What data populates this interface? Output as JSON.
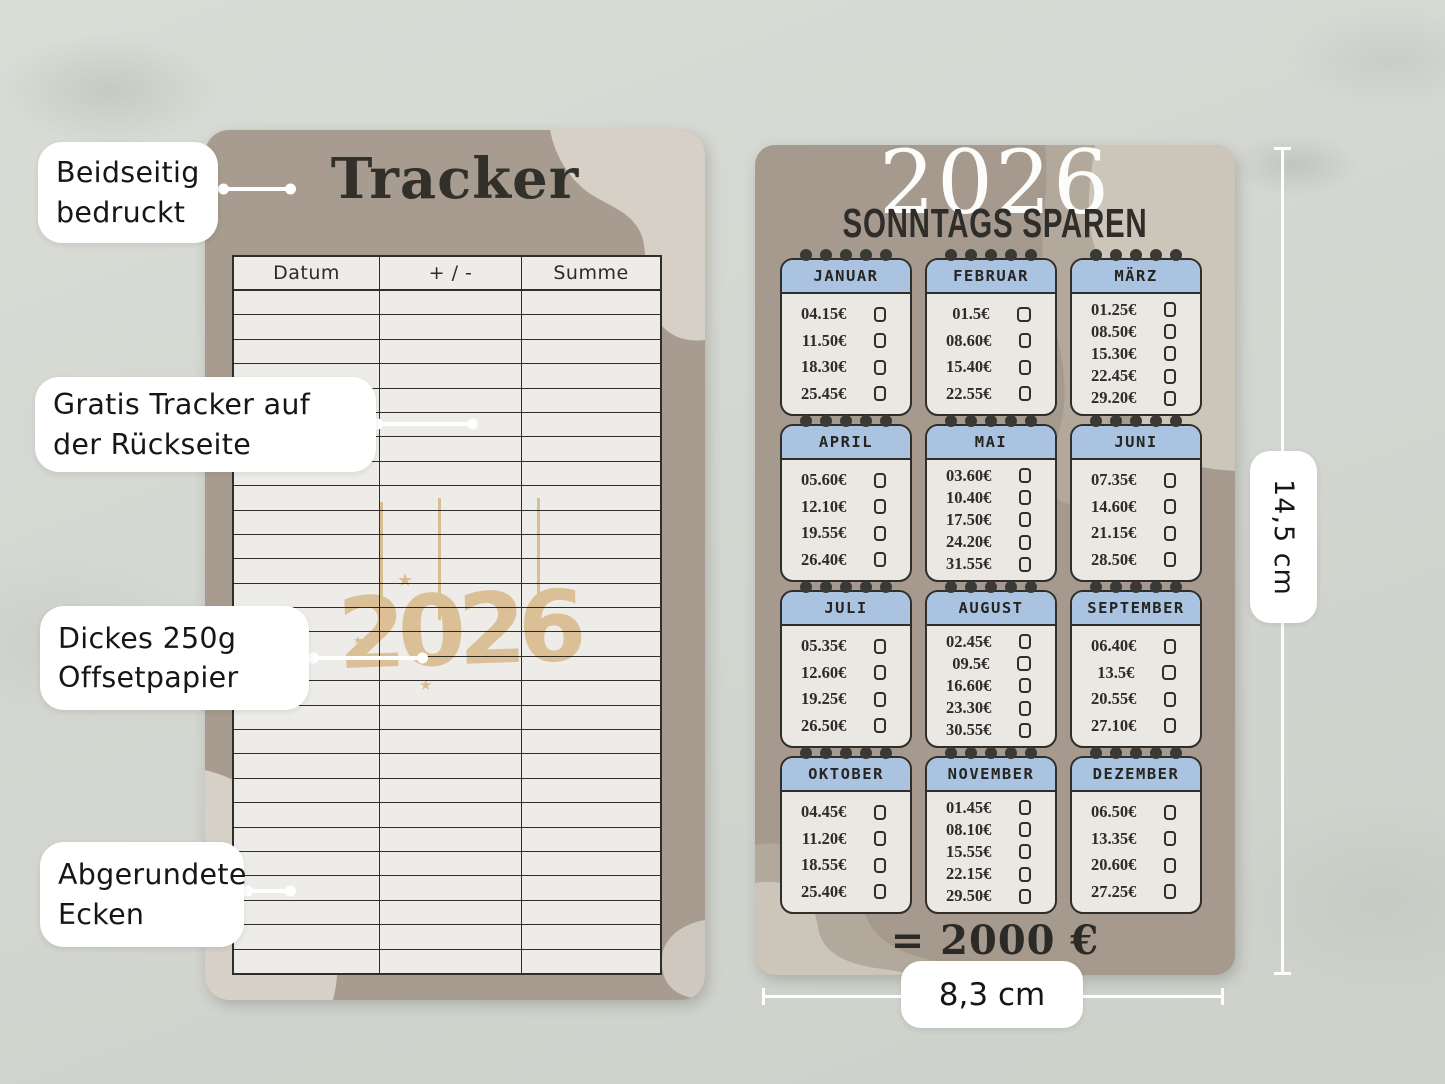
{
  "tracker_card": {
    "title": "Tracker",
    "columns": [
      "Datum",
      "+ / -",
      "Summe"
    ],
    "watermark": "2026",
    "empty_row_count": 28
  },
  "savings_card": {
    "year": "2026",
    "subtitle": "SONNTAGS SPAREN",
    "total": "= 2000 €",
    "months": [
      {
        "name": "JANUAR",
        "entries": [
          {
            "date": "04.",
            "amount": "15€"
          },
          {
            "date": "11.",
            "amount": "50€"
          },
          {
            "date": "18.",
            "amount": "30€"
          },
          {
            "date": "25.",
            "amount": "45€"
          }
        ]
      },
      {
        "name": "FEBRUAR",
        "entries": [
          {
            "date": "01.",
            "amount": "5€"
          },
          {
            "date": "08.",
            "amount": "60€"
          },
          {
            "date": "15.",
            "amount": "40€"
          },
          {
            "date": "22.",
            "amount": "55€"
          }
        ]
      },
      {
        "name": "MÄRZ",
        "entries": [
          {
            "date": "01.",
            "amount": "25€"
          },
          {
            "date": "08.",
            "amount": "50€"
          },
          {
            "date": "15.",
            "amount": "30€"
          },
          {
            "date": "22.",
            "amount": "45€"
          },
          {
            "date": "29.",
            "amount": "20€"
          }
        ]
      },
      {
        "name": "APRIL",
        "entries": [
          {
            "date": "05.",
            "amount": "60€"
          },
          {
            "date": "12.",
            "amount": "10€"
          },
          {
            "date": "19.",
            "amount": "55€"
          },
          {
            "date": "26.",
            "amount": "40€"
          }
        ]
      },
      {
        "name": "MAI",
        "entries": [
          {
            "date": "03.",
            "amount": "60€"
          },
          {
            "date": "10.",
            "amount": "40€"
          },
          {
            "date": "17.",
            "amount": "50€"
          },
          {
            "date": "24.",
            "amount": "20€"
          },
          {
            "date": "31.",
            "amount": "55€"
          }
        ]
      },
      {
        "name": "JUNI",
        "entries": [
          {
            "date": "07.",
            "amount": "35€"
          },
          {
            "date": "14.",
            "amount": "60€"
          },
          {
            "date": "21.",
            "amount": "15€"
          },
          {
            "date": "28.",
            "amount": "50€"
          }
        ]
      },
      {
        "name": "JULI",
        "entries": [
          {
            "date": "05.",
            "amount": "35€"
          },
          {
            "date": "12.",
            "amount": "60€"
          },
          {
            "date": "19.",
            "amount": "25€"
          },
          {
            "date": "26.",
            "amount": "50€"
          }
        ]
      },
      {
        "name": "AUGUST",
        "entries": [
          {
            "date": "02.",
            "amount": "45€"
          },
          {
            "date": "09.",
            "amount": "5€"
          },
          {
            "date": "16.",
            "amount": "60€"
          },
          {
            "date": "23.",
            "amount": "30€"
          },
          {
            "date": "30.",
            "amount": "55€"
          }
        ]
      },
      {
        "name": "SEPTEMBER",
        "entries": [
          {
            "date": "06.",
            "amount": "40€"
          },
          {
            "date": "13.",
            "amount": "5€"
          },
          {
            "date": "20.",
            "amount": "55€"
          },
          {
            "date": "27.",
            "amount": "10€"
          }
        ]
      },
      {
        "name": "OKTOBER",
        "entries": [
          {
            "date": "04.",
            "amount": "45€"
          },
          {
            "date": "11.",
            "amount": "20€"
          },
          {
            "date": "18.",
            "amount": "55€"
          },
          {
            "date": "25.",
            "amount": "40€"
          }
        ]
      },
      {
        "name": "NOVEMBER",
        "entries": [
          {
            "date": "01.",
            "amount": "45€"
          },
          {
            "date": "08.",
            "amount": "10€"
          },
          {
            "date": "15.",
            "amount": "55€"
          },
          {
            "date": "22.",
            "amount": "15€"
          },
          {
            "date": "29.",
            "amount": "50€"
          }
        ]
      },
      {
        "name": "DEZEMBER",
        "entries": [
          {
            "date": "06.",
            "amount": "50€"
          },
          {
            "date": "13.",
            "amount": "35€"
          },
          {
            "date": "20.",
            "amount": "60€"
          },
          {
            "date": "27.",
            "amount": "25€"
          }
        ]
      }
    ]
  },
  "annotations": {
    "labels": [
      {
        "lines": [
          "Beidseitig",
          "bedruckt"
        ]
      },
      {
        "lines": [
          "Gratis Tracker auf",
          "der Rückseite"
        ]
      },
      {
        "lines": [
          "Dickes 250g",
          "Offsetpapier"
        ]
      },
      {
        "lines": [
          "Abgerundete",
          "Ecken"
        ]
      }
    ],
    "dimensions": {
      "height_label": "14,5 cm",
      "width_label": "8,3 cm"
    }
  },
  "colors": {
    "wall": "#d4d7d1",
    "card_taupe": "#a79c8f",
    "blob_light": "#d6d0c7",
    "blob_mid": "#b2a89c",
    "paper": "#edece8",
    "month_header_blue": "#a9c3e0",
    "ink": "#2f2e2b",
    "watermark_beige": "#ecd0a6",
    "annotation_white": "#ffffff"
  }
}
